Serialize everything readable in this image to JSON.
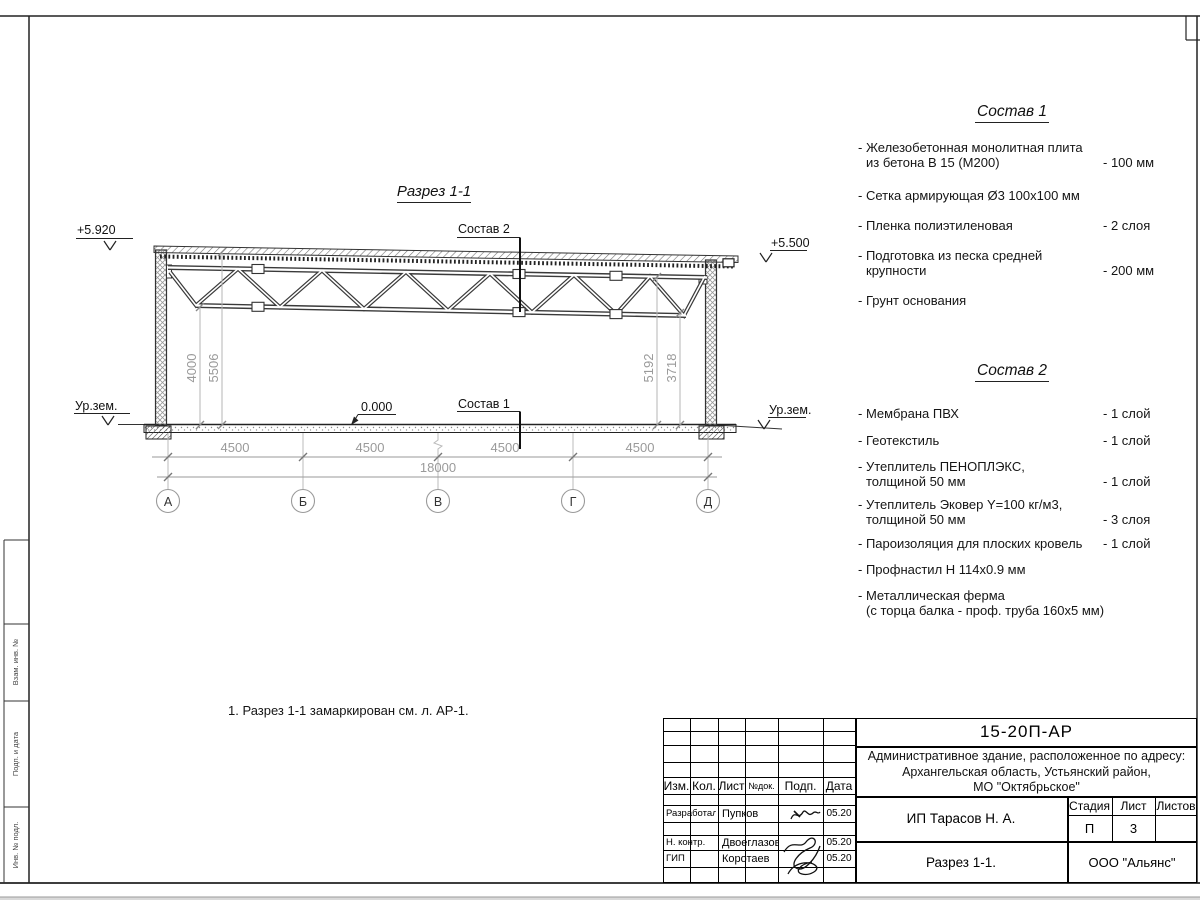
{
  "frame": {
    "margin_labels": [
      "Взам. инв. №",
      "Подп. и дата",
      "Инв. № подл."
    ]
  },
  "drawing": {
    "section_title": "Разрез 1-1",
    "elev_left": "+5.920",
    "elev_right": "+5.500",
    "ground_left": "Ур.зем.",
    "ground_right": "Ур.зем.",
    "zero": "0.000",
    "leader1": "Состав 1",
    "leader2": "Состав 2",
    "dim_v": [
      "4000",
      "5506",
      "5192",
      "3718"
    ],
    "dim_spans": [
      "4500",
      "4500",
      "4500",
      "4500"
    ],
    "dim_total": "18000",
    "axes": [
      "А",
      "Б",
      "В",
      "Г",
      "Д"
    ]
  },
  "lists": {
    "s1": {
      "title": "Состав 1",
      "items": [
        {
          "line1": "- Железобетонная  монолитная плита",
          "line2": "из бетона В 15 (М200)",
          "value": "- 100 мм"
        },
        {
          "line1": "- Сетка армирующая Ø3 100х100 мм"
        },
        {
          "line1": "- Пленка полиэтиленовая",
          "value": "-  2 слоя"
        },
        {
          "line1": "- Подготовка из песка средней",
          "line2": "крупности",
          "value": "- 200 мм"
        },
        {
          "line1": "- Грунт основания"
        }
      ]
    },
    "s2": {
      "title": "Состав 2",
      "items": [
        {
          "line1": "- Мембрана ПВХ",
          "value": "- 1 слой"
        },
        {
          "line1": "- Геотекстиль",
          "value": "- 1 слой"
        },
        {
          "line1": "- Утеплитель ПЕНОПЛЭКС,",
          "line2": "толщиной 50 мм",
          "value": "- 1 слой"
        },
        {
          "line1": "- Утеплитель Эковер Y=100 кг/м3,",
          "line2": "толщиной 50 мм",
          "value": "- 3 слоя"
        },
        {
          "line1": "- Пароизоляция для плоских кровель",
          "value": "- 1 слой"
        },
        {
          "line1": "- Профнастил Н 114х0.9 мм"
        },
        {
          "line1": "- Металлическая ферма",
          "line2": "(с торца балка - проф. труба 160х5 мм)"
        }
      ]
    }
  },
  "note": {
    "text": "1. Разрез 1-1 замаркирован см. л. АР-1."
  },
  "titleblock": {
    "doc_number": "15-20П-АР",
    "address_lines": [
      "Административное здание, расположенное по адресу:",
      "Архангельская область, Устьянский район,",
      "МО \"Октябрьское\""
    ],
    "header_cols": [
      "Изм.",
      "Кол.",
      "Лист",
      "№док.",
      "Подп.",
      "Дата"
    ],
    "rows": [
      {
        "role": "Разработал",
        "name": "Пупков",
        "date": "05.20"
      },
      {
        "role": "Н. контр.",
        "name": "Двоеглазов",
        "date": "05.20"
      },
      {
        "role": "ГИП",
        "name": "Коротаев",
        "date": "05.20"
      }
    ],
    "client": "ИП Тарасов Н. А.",
    "stage_label": "Стадия",
    "sheet_label": "Лист",
    "sheets_label": "Листов",
    "stage": "П",
    "sheet": "3",
    "sheet_title": "Разрез 1-1.",
    "company": "ООО \"Альянс\""
  }
}
